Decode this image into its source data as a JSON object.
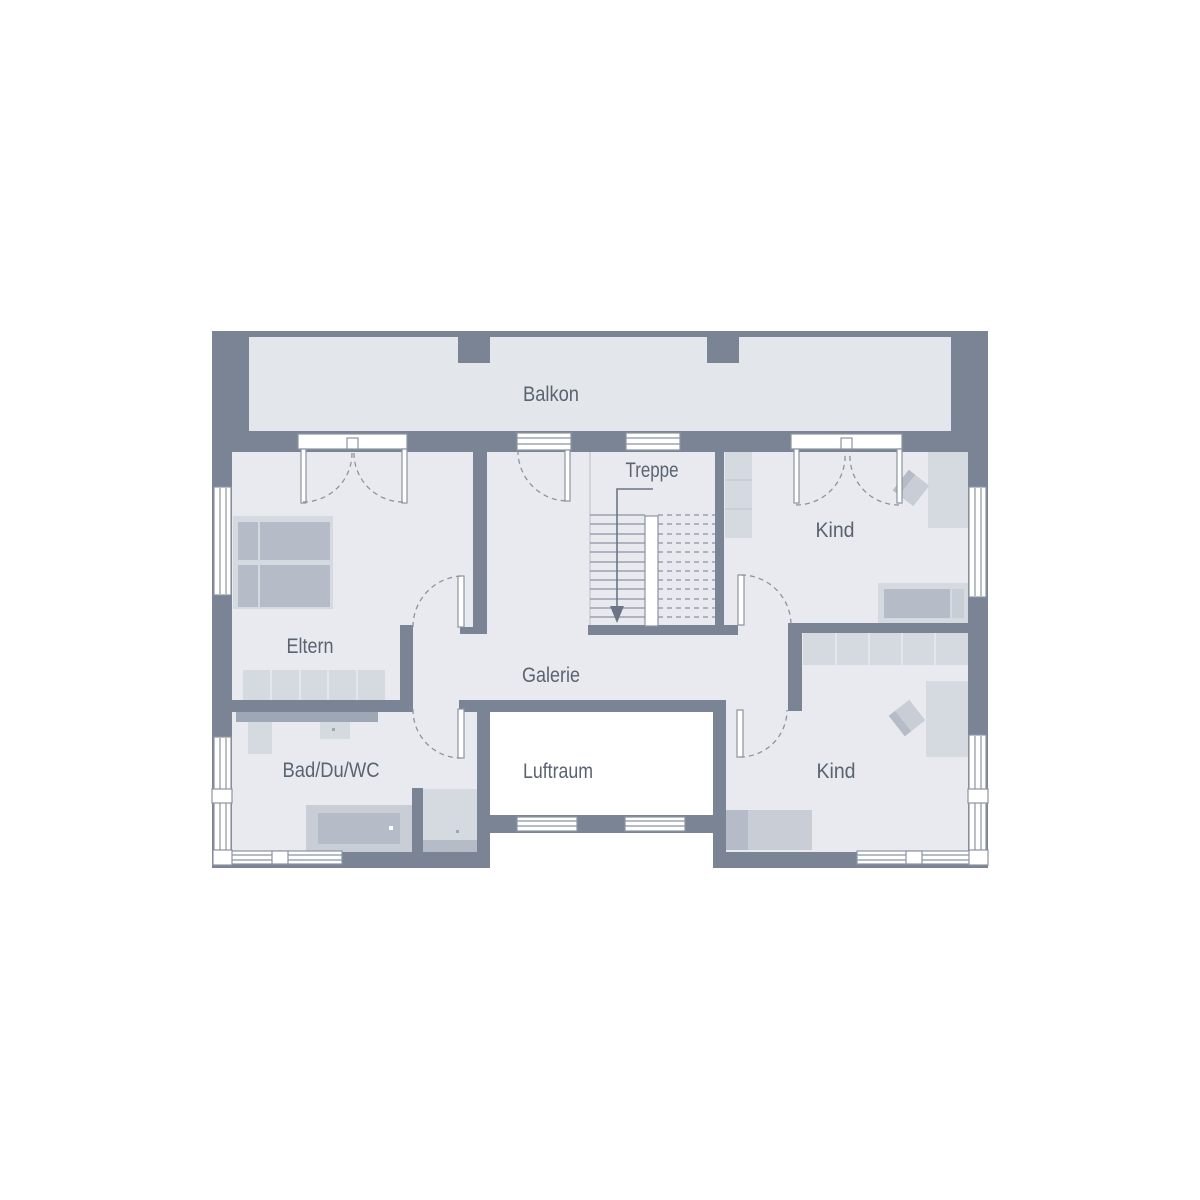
{
  "colors": {
    "wall": "#7a8494",
    "floor": "#e8eaef",
    "floor_balkon": "#e3e6eb",
    "furn_light": "#d5d9e0",
    "furn_mid": "#c9cdd5",
    "furn_dark": "#b5bbc7",
    "counter": "#9ea7b5",
    "line": "#8b94a2",
    "text": "#5a6370",
    "arrow": "#6b7585",
    "background": "#ffffff"
  },
  "rooms": {
    "balkon": {
      "label": "Balkon"
    },
    "treppe": {
      "label": "Treppe"
    },
    "kind_top": {
      "label": "Kind"
    },
    "eltern": {
      "label": "Eltern"
    },
    "galerie": {
      "label": "Galerie"
    },
    "bad": {
      "label": "Bad/Du/WC"
    },
    "luftraum": {
      "label": "Luftraum"
    },
    "kind_bottom": {
      "label": "Kind"
    }
  },
  "stairs": {
    "treads_visible": 12,
    "direction_arrow": "down",
    "handrail": "center"
  },
  "openings": {
    "balcony_doors": [
      {
        "room": "eltern",
        "type": "double-french-door"
      },
      {
        "room": "galerie",
        "type": "single-door"
      },
      {
        "room": "kind_top",
        "type": "double-french-door"
      }
    ],
    "interior_doors": [
      "eltern",
      "bad",
      "kind_top",
      "kind_bottom"
    ],
    "windows": [
      "treppe-north",
      "eltern-west",
      "bad-west",
      "kind-top-east",
      "kind-bottom-east",
      "luftraum-south-left",
      "luftraum-south-right",
      "bad-south-corner",
      "kind-bottom-south-corner"
    ]
  },
  "furniture": {
    "eltern": [
      "double-bed",
      "sideboard"
    ],
    "bad": [
      "vanity-counter",
      "wc",
      "washbasin",
      "bathtub",
      "shower"
    ],
    "kind_top": [
      "wardrobe",
      "desk",
      "chair",
      "bed"
    ],
    "kind_bottom": [
      "wardrobe",
      "desk",
      "chair",
      "bed"
    ]
  }
}
